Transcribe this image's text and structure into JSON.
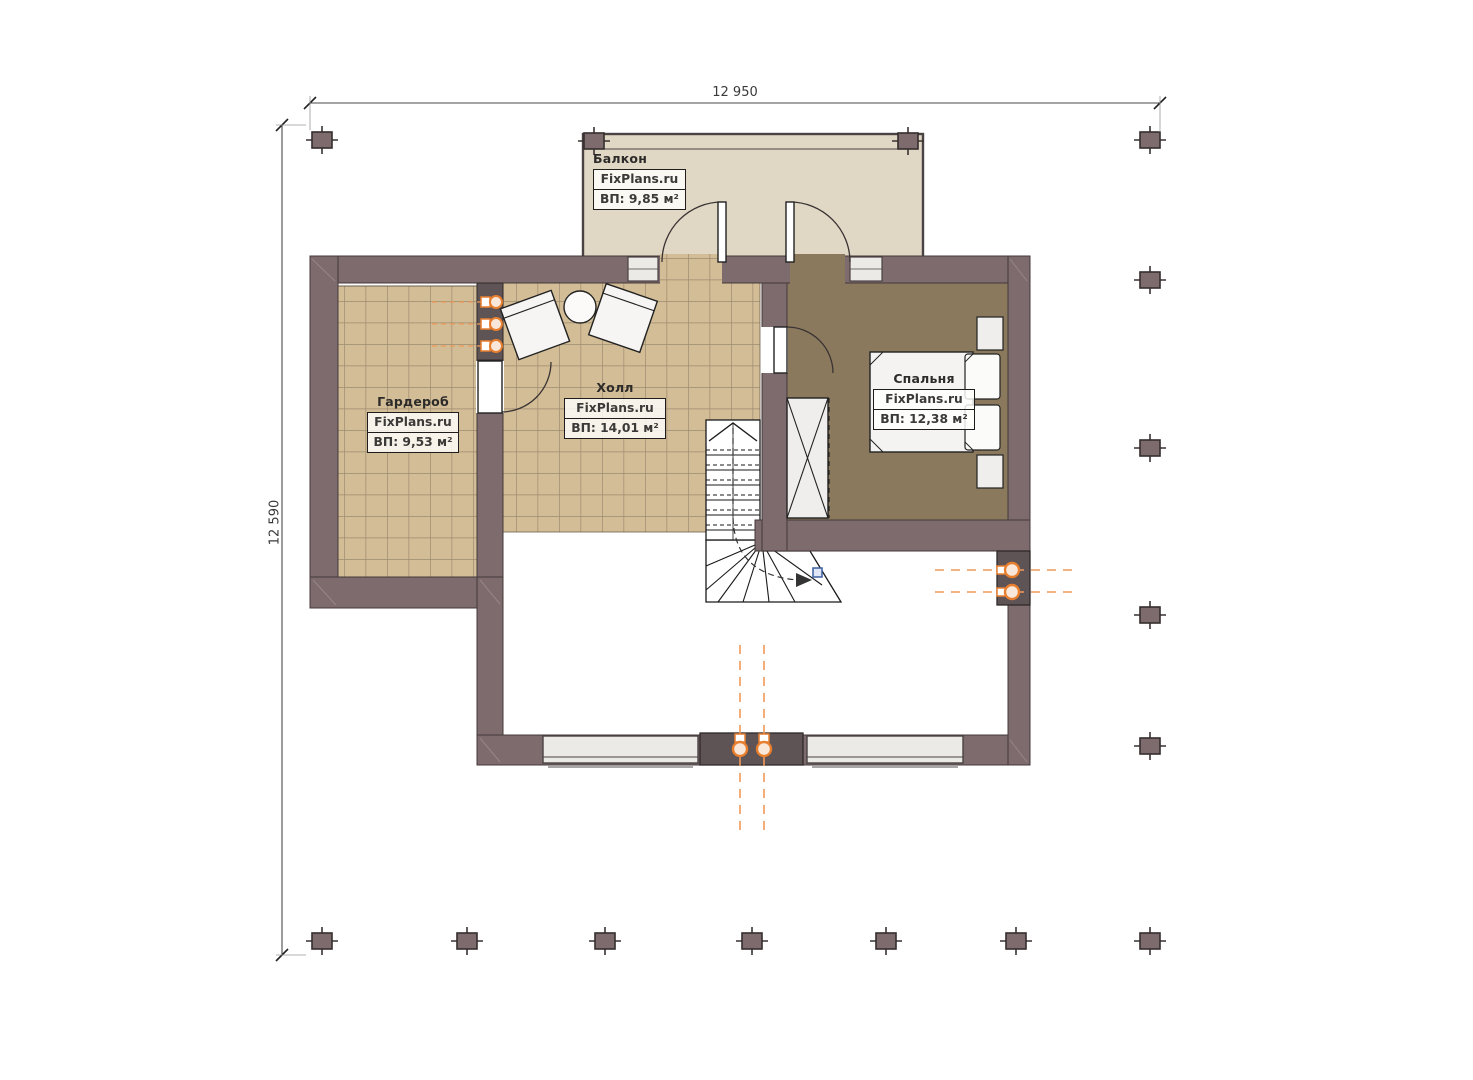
{
  "plan": {
    "type": "floor-plan"
  },
  "dimensions": {
    "top_width": "12 950",
    "left_height": "12 590"
  },
  "watermark": "FixPlans.ru",
  "rooms": {
    "balcony": {
      "name": "Балкон",
      "area": "ВП: 9,85 м²"
    },
    "wardrobe": {
      "name": "Гардероб",
      "area": "ВП: 9,53 м²"
    },
    "hall": {
      "name": "Холл",
      "area": "ВП: 14,01 м²"
    },
    "bedroom": {
      "name": "Спальня",
      "area": "ВП: 12,38 м²"
    }
  },
  "furniture": [
    "armchair",
    "armchair",
    "round-table",
    "bed",
    "nightstand",
    "nightstand",
    "closet",
    "winder-stairs"
  ],
  "icons": {
    "column-marker": "filled-square-with-cross-ticks",
    "heater-icon": "orange-circle-with-box",
    "riser-icon": "orange-circle-with-box",
    "stairs-up-arrow": "chevron-up",
    "door-swing": "quarter-arc"
  },
  "colors": {
    "wall": "#7d6b6d",
    "wall_dark": "#5e5355",
    "tile_floor": "#d3bd96",
    "tile_grid": "#9d8c70",
    "bedroom_floor": "#8a795c",
    "balcony_floor": "#e0d7c4",
    "window_fill": "#eceae6",
    "outline": "#443a3b",
    "accent_orange": "#e87f2f",
    "dash_orange": "#f09a5a",
    "marker_blue": "#3a5fa0"
  }
}
